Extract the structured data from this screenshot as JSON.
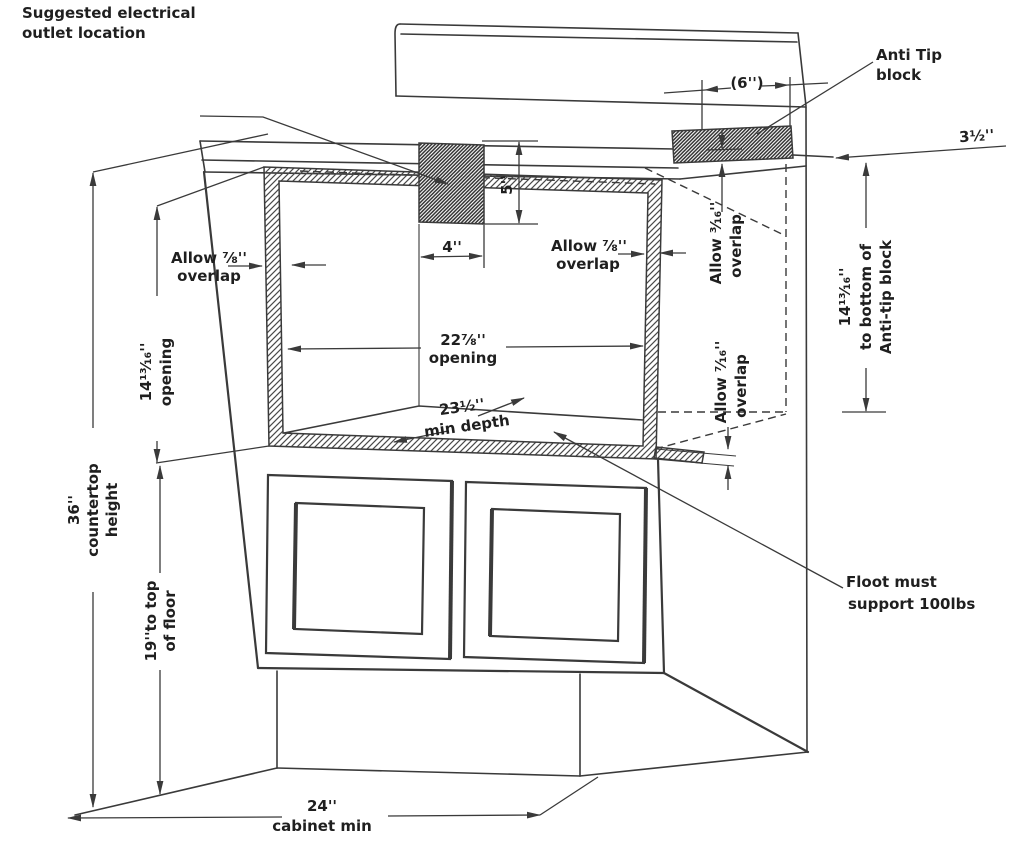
{
  "colors": {
    "line": "#3a3a3a",
    "text": "#1f1f1f",
    "background": "#ffffff"
  },
  "labels": {
    "suggested_outlet": {
      "line1": "Suggested electrical",
      "line2": "outlet location"
    },
    "anti_tip": {
      "line1": "Anti Tip",
      "line2": "block"
    },
    "dim_six": "(6'')",
    "dim_three_half": "3½''",
    "dim_five": "5''",
    "dim_four": "4''",
    "allow_left": {
      "line1": "Allow ⅞''",
      "line2": "overlap"
    },
    "allow_right": {
      "line1": "Allow ⅞''",
      "line2": "overlap"
    },
    "allow_316": {
      "line1": "Allow ³⁄₁₆''",
      "line2": "overlap"
    },
    "allow_716": {
      "line1": "Allow ⁷⁄₁₆''",
      "line2": "overlap"
    },
    "opening_height": {
      "line1": "14¹³⁄₁₆''",
      "line2": "opening"
    },
    "opening_width": {
      "line1": "22⅞''",
      "line2": "opening"
    },
    "min_depth": {
      "line1": "23½''",
      "line2": "min depth"
    },
    "anti_tip_height": {
      "line1": "14¹³⁄₁₆''",
      "line2": "to bottom of",
      "line3": "Anti-tip block"
    },
    "countertop_height": {
      "line1": "36''",
      "line2": "countertop",
      "line3": "height"
    },
    "floor_height": {
      "line1": "19''to top",
      "line2": "of floor"
    },
    "cabinet_min": {
      "line1": "24''",
      "line2": "cabinet min"
    },
    "floor_support": {
      "line1": "Floot must",
      "line2": "support 100lbs"
    }
  }
}
